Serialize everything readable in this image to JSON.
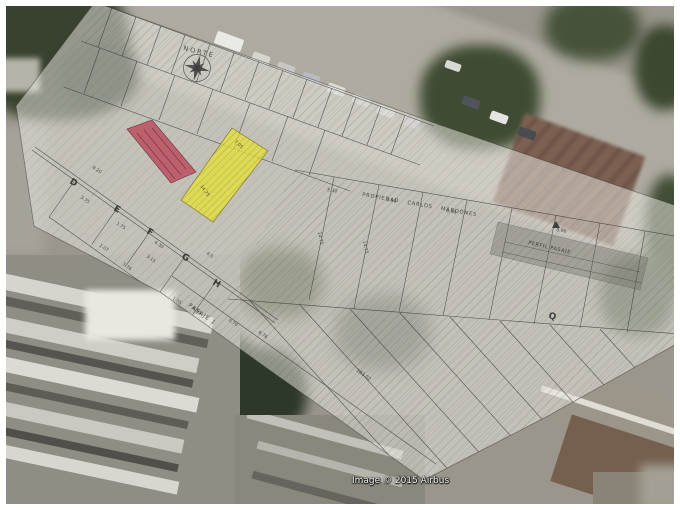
{
  "map_overlay": {
    "north_label": "NORTE",
    "property_label": "PROPIEDAD CARLOS MARDONES",
    "profile_label": "PERFIL PASAJE",
    "alley_label": "PASAJE 1",
    "distance_label": "163.02",
    "station_labels": [
      "D",
      "E",
      "F",
      "G",
      "H",
      "Q"
    ],
    "measurements": [
      "8.20",
      "3.75",
      "1.75",
      "4.30",
      "3.15",
      "1.07",
      "7.76",
      "0.78",
      "1.05",
      "4.5",
      "5.30",
      "5.90",
      "6.90",
      "8.96",
      "14.75",
      "14.75",
      "6.95",
      "0.70",
      "6.76",
      "7.05",
      "14.75"
    ],
    "parcels": {
      "yellow": {
        "color": "#e6e23e"
      },
      "red": {
        "color": "#bb5060"
      }
    },
    "sheet_color": "rgba(234,232,224,0.53)",
    "line_color": "#2f2f2f"
  },
  "attribution": "Image © 2015 Airbus"
}
